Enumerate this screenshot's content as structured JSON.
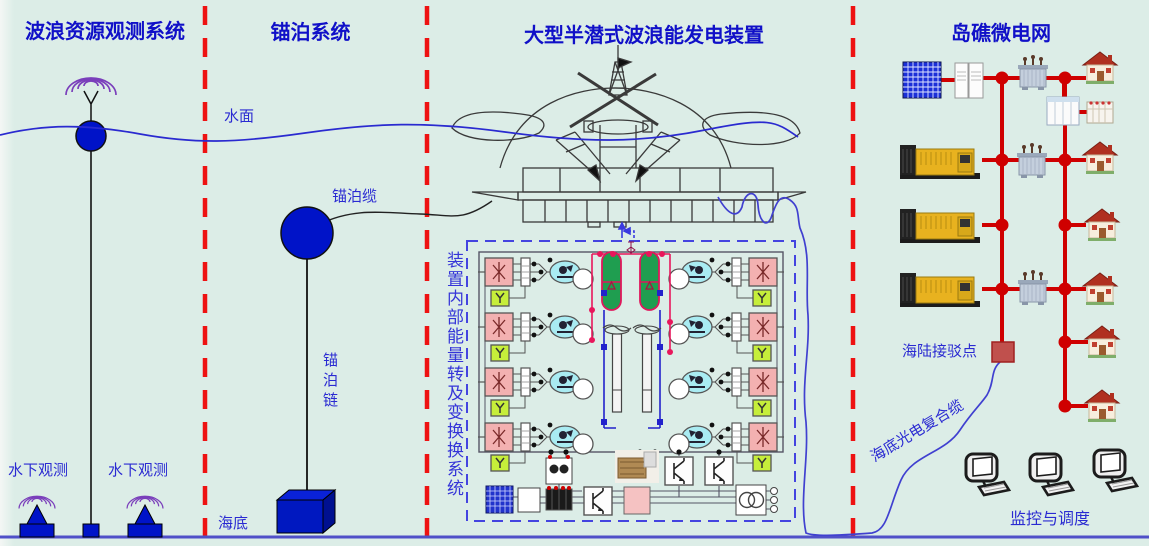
{
  "sections": [
    {
      "title": "波浪资源观测系统"
    },
    {
      "title": "锚泊系统"
    },
    {
      "title": "大型半潜式波浪能发电装置"
    },
    {
      "title": "岛礁微电网"
    }
  ],
  "labels": {
    "water_surface": "水面",
    "seabed": "海底",
    "mooring_cable": "锚泊缆",
    "mooring_chain": "锚泊链",
    "underwater_obs_1": "水下观测",
    "underwater_obs_2": "水下观测",
    "device_internal_system": "装置内部能量转及变换换系统",
    "sea_land_connection_point": "海陆接驳点",
    "submarine_cable": "海底光电复合缆",
    "monitoring_dispatch": "监控与调度"
  },
  "colors": {
    "background": "#dcede7",
    "title_blue": "#1010c8",
    "label_blue": "#2a2ad2",
    "divider_red": "#ee1212",
    "grid_red": "#cf0000",
    "buoy_blue": "#0013c8",
    "accumulator_green": "#1f9e50",
    "hydraulic_pink": "#f3b1b1",
    "pump_cyan": "#a9ebf2",
    "y_box_green": "#c6ee3a",
    "magenta_line": "#e8175c",
    "sea_line_blue": "#2a2ad0"
  }
}
